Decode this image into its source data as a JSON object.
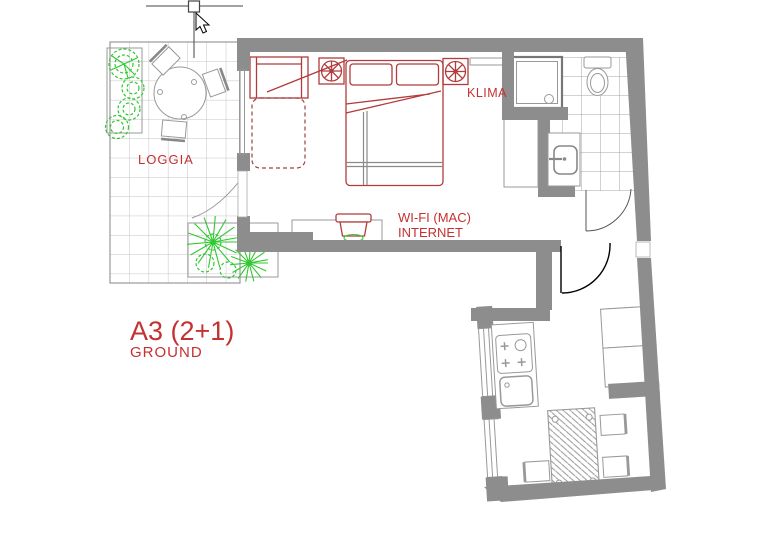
{
  "title": "Apartment floor plan A3 (2+1), ground floor",
  "labels": {
    "loggia": "LOGGIA",
    "klima": "KLIMA",
    "wifi": "WI-FI (MAC)",
    "internet": "INTERNET",
    "unit": "A3 (2+1)",
    "floor": "GROUND"
  },
  "colors": {
    "wall": "#8d8d8d",
    "furniture_red": "#b23b3b",
    "label_red": "#c43131",
    "plant_green": "#2fc82f",
    "line_gray": "#999999",
    "tile_gray": "#a6a6a6",
    "loggia_tile": "#c3c3c3",
    "background": "#ffffff",
    "cursor_black": "#000000"
  },
  "icons": [
    {
      "name": "ac-fan-icon",
      "meaning": "air conditioning (KLIMA) unit"
    },
    {
      "name": "cursor-arrow-icon",
      "meaning": "mouse pointer"
    },
    {
      "name": "grip-handle-icon",
      "meaning": "CAD selection grip"
    },
    {
      "name": "bush-icon",
      "meaning": "plant in loggia planter"
    },
    {
      "name": "palm-icon",
      "meaning": "large plant in loggia planter"
    }
  ],
  "rooms": [
    "loggia",
    "bedroom-living",
    "bathroom",
    "hallway",
    "kitchen-dining"
  ]
}
